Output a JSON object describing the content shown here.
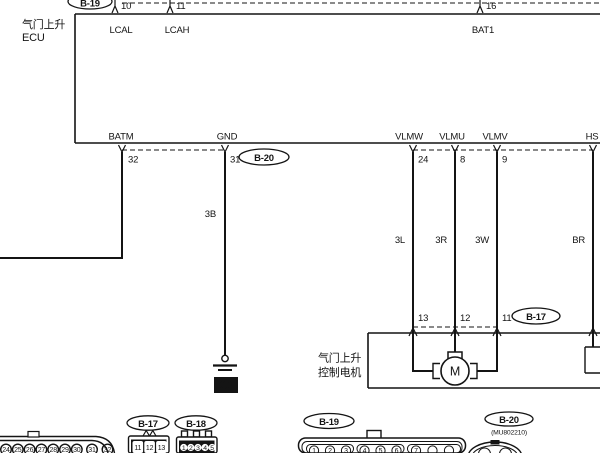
{
  "ecu": {
    "title_line1": "气门上升",
    "title_line2": "ECU"
  },
  "top_connector": {
    "label": "B-19",
    "pins": [
      {
        "num": "10",
        "signal": "LCAL"
      },
      {
        "num": "11",
        "signal": "LCAH"
      },
      {
        "num": "16",
        "signal": "BAT1"
      }
    ]
  },
  "ecu_pins": {
    "batm": {
      "num": "32",
      "signal": "BATM"
    },
    "gnd": {
      "num": "31",
      "signal": "GND",
      "connector": "B-20"
    },
    "vlmw": {
      "num": "24",
      "signal": "VLMW",
      "wire": "3L"
    },
    "vlmu": {
      "num": "8",
      "signal": "VLMU",
      "wire": "3R"
    },
    "vlmv": {
      "num": "9",
      "signal": "VLMV",
      "wire": "3W"
    },
    "hs": {
      "signal": "HS",
      "wire": "BR"
    }
  },
  "wires": {
    "gnd_wire": "3B"
  },
  "ground": {
    "num": "23"
  },
  "motor": {
    "label_line1": "气门上升",
    "label_line2": "控制电机",
    "symbol": "M",
    "connector": "B-17",
    "pins": [
      {
        "num": "13"
      },
      {
        "num": "12"
      },
      {
        "num": "11"
      }
    ]
  },
  "bottom_connectors": {
    "left_partial": {
      "pins": [
        "24",
        "25",
        "26",
        "27",
        "28",
        "29",
        "30",
        "31",
        "32"
      ]
    },
    "b17": {
      "label": "B-17",
      "pins": [
        "11",
        "12",
        "13"
      ]
    },
    "b18": {
      "label": "B-18",
      "pins": [
        "1",
        "2",
        "3",
        "4",
        "5"
      ]
    },
    "b19": {
      "label": "B-19",
      "pins": [
        "1",
        "2",
        "3",
        "4",
        "5",
        "6",
        "7"
      ]
    },
    "b20": {
      "label": "B-20",
      "part": "(MU802210)"
    }
  }
}
